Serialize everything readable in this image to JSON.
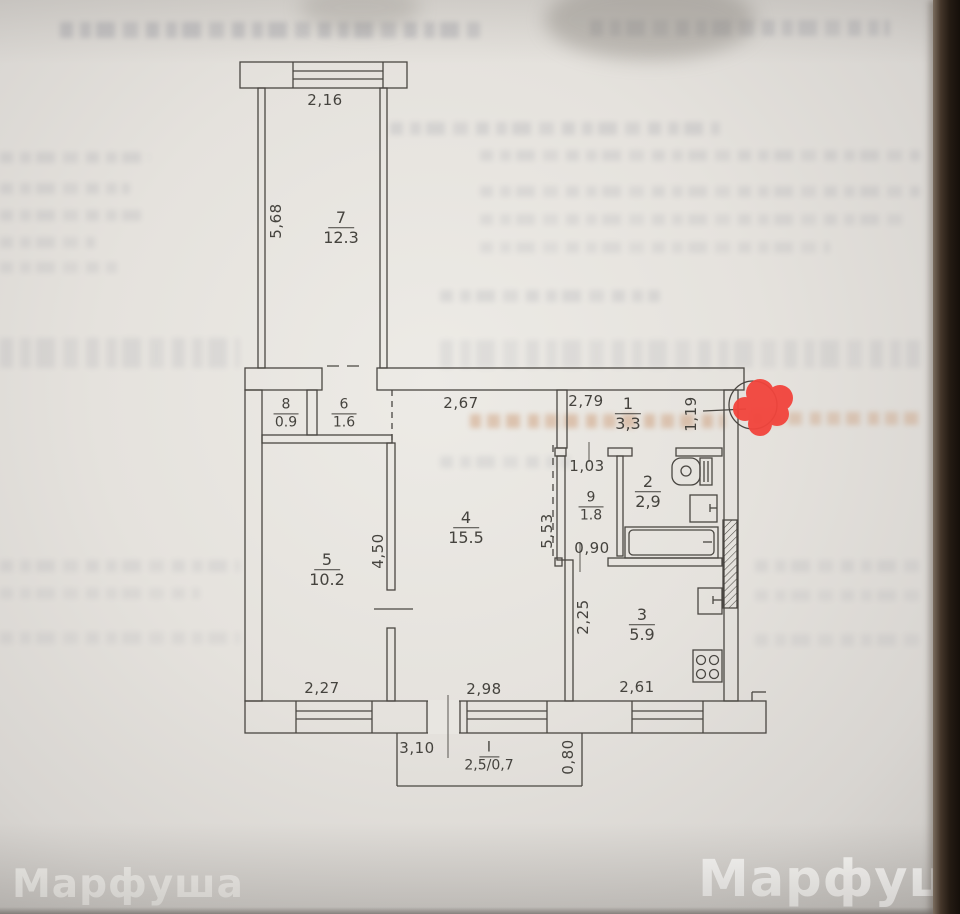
{
  "document_kind": "technical-passport-floor-plan-photo",
  "watermark": {
    "left": "Марфуша",
    "right": "Марфуша"
  },
  "colors": {
    "plan_line": "#4a4742",
    "red_marker": "#f2443c",
    "paper": "#e7e4df"
  },
  "floor_plan": {
    "rooms": [
      {
        "number": "7",
        "area": "12.3"
      },
      {
        "number": "8",
        "area": "0.9"
      },
      {
        "number": "6",
        "area": "1.6"
      },
      {
        "number": "1",
        "area": "3,3"
      },
      {
        "number": "9",
        "area": "1.8"
      },
      {
        "number": "2",
        "area": "2,9"
      },
      {
        "number": "4",
        "area": "15.5"
      },
      {
        "number": "5",
        "area": "10.2"
      },
      {
        "number": "3",
        "area": "5.9"
      },
      {
        "number": "I",
        "area": "2,5/0,7"
      }
    ],
    "dimensions": [
      {
        "text": "2,16"
      },
      {
        "text": "5,68"
      },
      {
        "text": "2,67"
      },
      {
        "text": "2,79"
      },
      {
        "text": "1,19"
      },
      {
        "text": "1,03"
      },
      {
        "text": "0,90"
      },
      {
        "text": "5,53"
      },
      {
        "text": "4,50"
      },
      {
        "text": "2,25"
      },
      {
        "text": "2,27"
      },
      {
        "text": "2,98"
      },
      {
        "text": "2,61"
      },
      {
        "text": "3,10"
      },
      {
        "text": "0,80"
      }
    ]
  }
}
